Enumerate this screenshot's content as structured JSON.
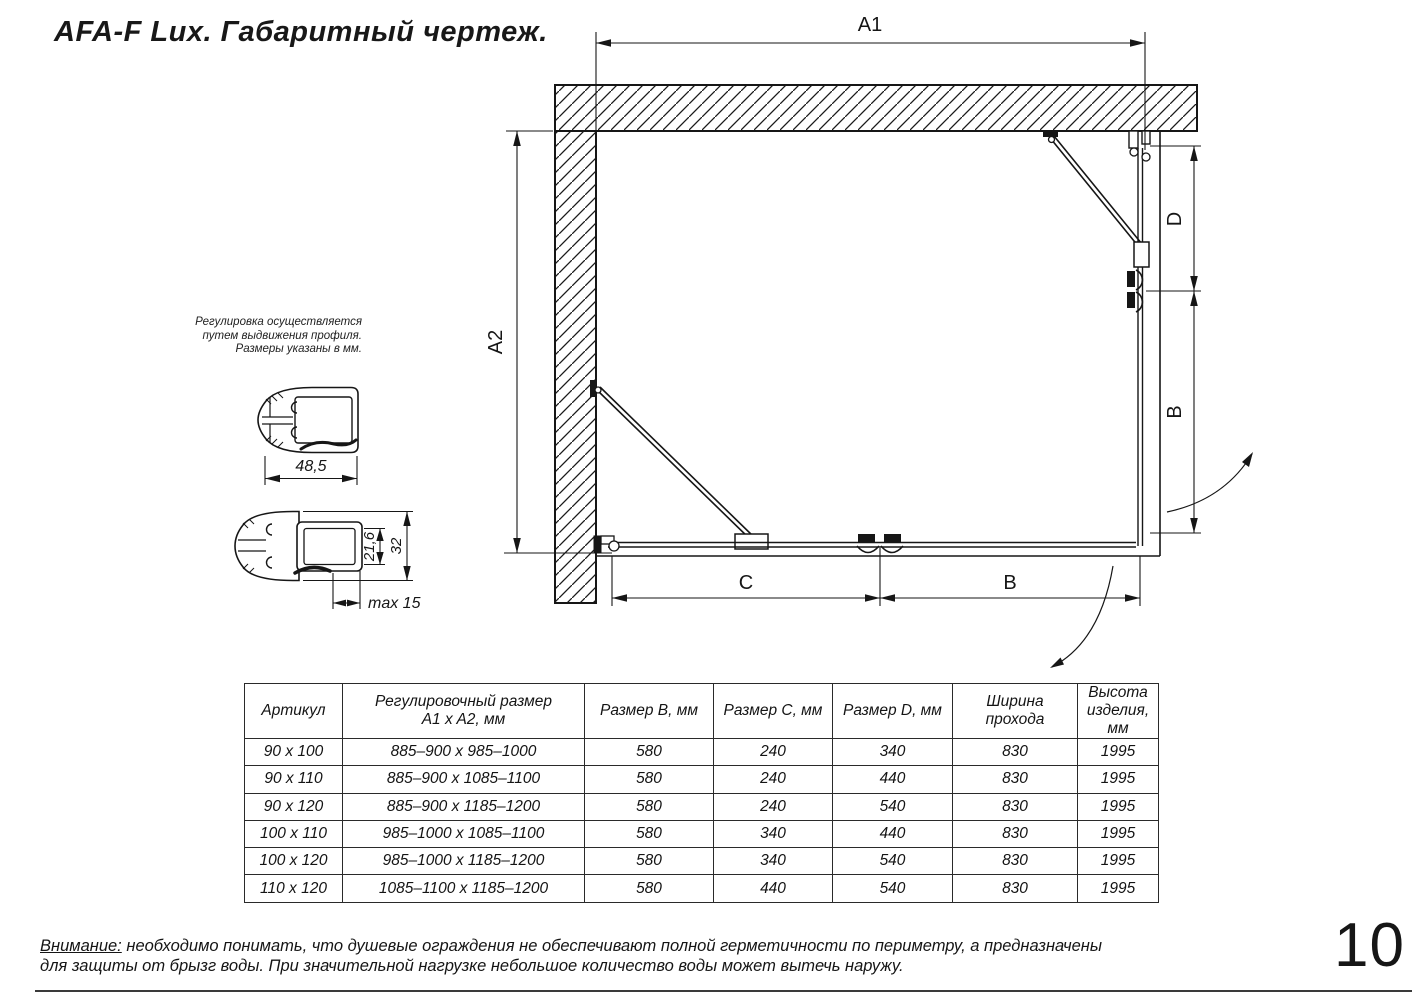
{
  "page": {
    "title": "AFA-F Lux. Габаритный чертеж.",
    "page_number": "10"
  },
  "drawing": {
    "labels": {
      "a1": "A1",
      "a2": "A2",
      "d": "D",
      "b_side": "B",
      "c": "C",
      "b_front": "B"
    }
  },
  "profiles": {
    "note_line1": "Регулировка осуществляется",
    "note_line2": "путем выдвижения профиля.",
    "note_line3": "Размеры указаны в мм.",
    "p1_width": "48,5",
    "p2_inner": "21,6",
    "p2_outer": "32",
    "p2_max": "max 15"
  },
  "table": {
    "headers": [
      "Артикул",
      "Регулировочный размер\nA1 x A2, мм",
      "Размер B, мм",
      "Размер C, мм",
      "Размер D, мм",
      "Ширина\nпрохода",
      "Высота\nизделия,\nмм"
    ],
    "rows": [
      [
        "90 x 100",
        "885–900 x 985–1000",
        "580",
        "240",
        "340",
        "830",
        "1995"
      ],
      [
        "90 x 110",
        "885–900 x 1085–1100",
        "580",
        "240",
        "440",
        "830",
        "1995"
      ],
      [
        "90 x 120",
        "885–900 x 1185–1200",
        "580",
        "240",
        "540",
        "830",
        "1995"
      ],
      [
        "100 x 110",
        "985–1000 x 1085–1100",
        "580",
        "340",
        "440",
        "830",
        "1995"
      ],
      [
        "100 x 120",
        "985–1000 x 1185–1200",
        "580",
        "340",
        "540",
        "830",
        "1995"
      ],
      [
        "110 x 120",
        "1085–1100 x 1185–1200",
        "580",
        "440",
        "540",
        "830",
        "1995"
      ]
    ]
  },
  "warning": {
    "label": "Внимание:",
    "line1_rest": " необходимо понимать, что душевые ограждения не обеспечивают полной герметичности по периметру, а предназначены",
    "line2": "для защиты от брызг воды. При значительной нагрузке небольшое количество воды может вытечь наружу."
  }
}
